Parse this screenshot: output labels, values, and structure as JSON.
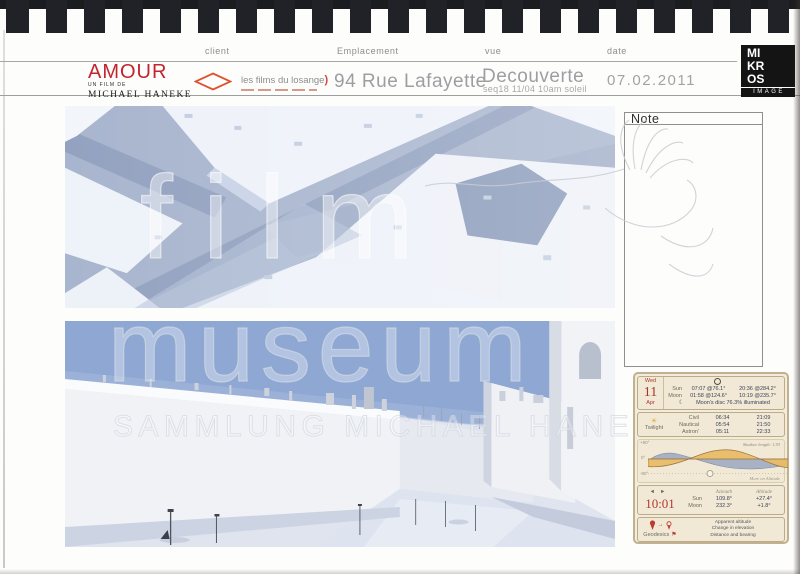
{
  "document": {
    "note_title": "Note",
    "watermarks": {
      "line1": "film",
      "line2": "museum",
      "line3": "SAMMLUNG MICHAEL HANEKE"
    }
  },
  "header": {
    "field_labels": {
      "client": "client",
      "location": "Emplacement",
      "view": "vue",
      "date": "date"
    },
    "production": {
      "title": "AMOUR",
      "credit": "UN FILM DE",
      "director": "MICHAEL HANEKE"
    },
    "company": {
      "name": "les films du losange",
      "bracket": ")"
    },
    "location_value": "94 Rue Lafayette",
    "view_value": "Decouverte",
    "view_detail": "seq18 11/04 10am soleil",
    "date_value": "07.02.2011",
    "studio": {
      "row1": "MI",
      "row2": "KR",
      "row3": "OS",
      "sub": "IMAGE"
    }
  },
  "ephemeris": {
    "date": {
      "weekday": "Wed",
      "day": "11",
      "month": "Apr"
    },
    "sun": {
      "label": "Sun",
      "rise": "07:07 @76.1°",
      "set": "20:36 @284.2°"
    },
    "moon": {
      "label": "Moon",
      "rise": "01:58 @124.6°",
      "set": "10:19 @235.7°"
    },
    "moon_disc": "Moon's disc 76.3% illuminated",
    "twilight": {
      "label": "Twilight",
      "rows": [
        {
          "name": "Civil",
          "am": "06:34",
          "pm": "21:09"
        },
        {
          "name": "Nautical",
          "am": "05:54",
          "pm": "21:50"
        },
        {
          "name": "Astron'",
          "am": "05:11",
          "pm": "22:33"
        }
      ]
    },
    "chart": {
      "y_top": "+90°",
      "y_mid": "0°",
      "y_bottom": "-90°",
      "shadow": "Shadow length: 1.93",
      "caption": "More on Altitude"
    },
    "time": {
      "value": "10:01",
      "prev": "◄",
      "next": "►"
    },
    "position": {
      "col1": "Azimuth",
      "col2": "Altitude",
      "rows": [
        {
          "name": "Sun",
          "azimuth": "109.8°",
          "altitude": "+27.4°"
        },
        {
          "name": "Moon",
          "azimuth": "232.3°",
          "altitude": "+1.8°"
        }
      ]
    },
    "geodesics": {
      "label": "Geodesics",
      "lines": [
        "Apparent altitude",
        "Change in elevation",
        "Distance and bearing"
      ]
    }
  },
  "colors": {
    "accent_red": "#c3242e",
    "losange_orange": "#e0512f",
    "card_red": "#b03a2c",
    "sun_curve": "#e9bc68",
    "moon_curve": "#a3aec4",
    "card_bg": "#f3ecdb"
  }
}
